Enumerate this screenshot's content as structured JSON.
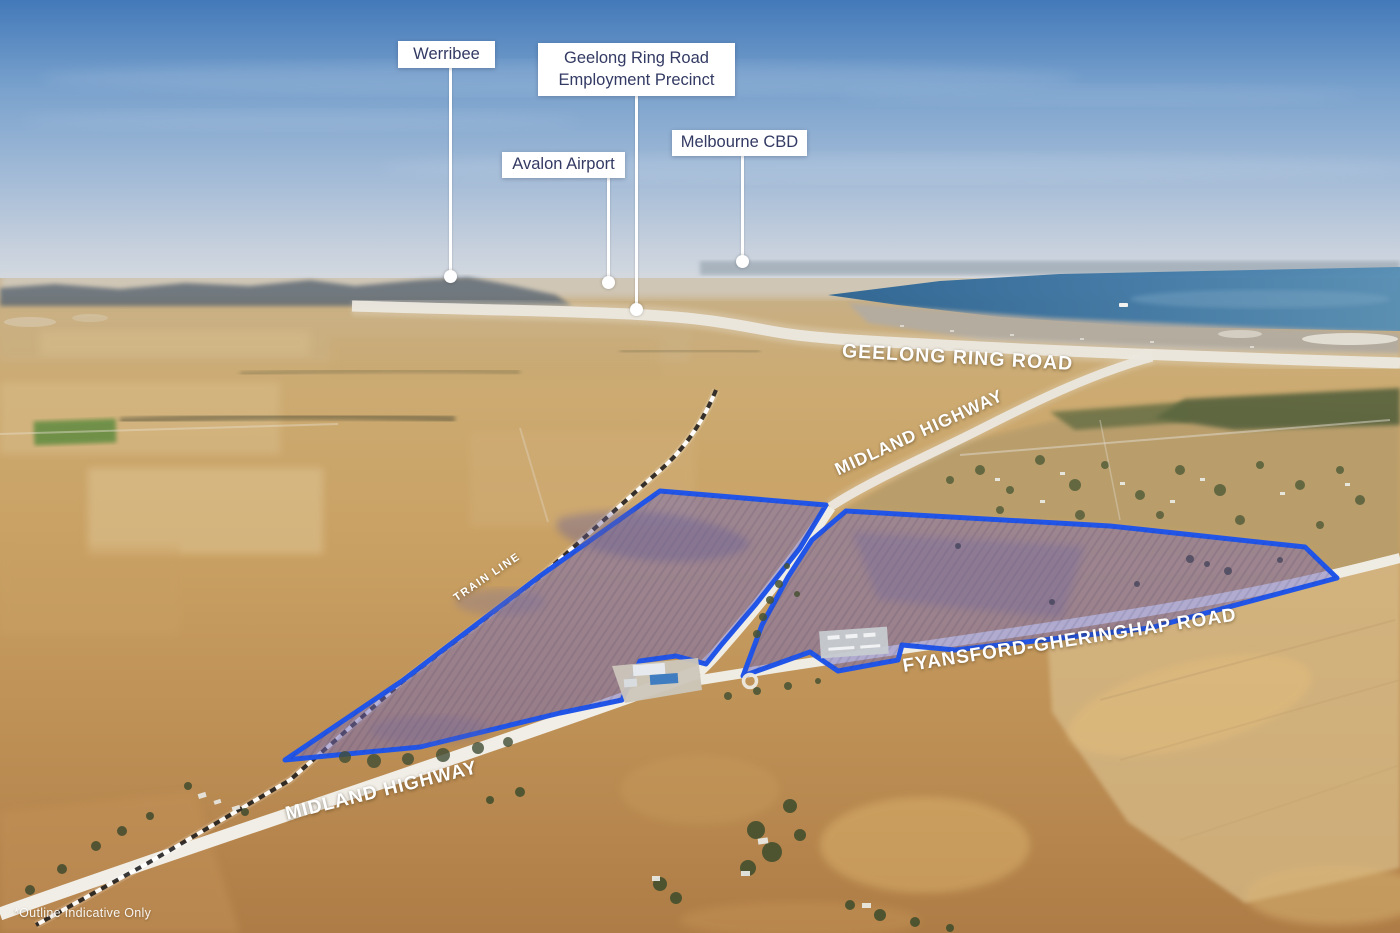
{
  "callouts": [
    {
      "label": "Werribee"
    },
    {
      "line1": "Geelong Ring Road",
      "line2": "Employment Precinct"
    },
    {
      "label": "Avalon Airport"
    },
    {
      "label": "Melbourne CBD"
    }
  ],
  "road_labels": [
    {
      "text": "GEELONG RING ROAD"
    },
    {
      "text": "MIDLAND HIGHWAY"
    },
    {
      "text": "TRAIN LINE"
    },
    {
      "text": "FYANSFORD-GHERINGHAP ROAD"
    },
    {
      "text": "MIDLAND HIGHWAY"
    }
  ],
  "disclaimer": "*Outline Indicative Only",
  "parcels": {
    "outline_color": "#2155E8",
    "fill_color": "rgba(114,106,186,0.5)",
    "west_points": "660,491 826,505 800,548 756,604 722,644 706,664 676,656 640,661 622,700 560,713 420,747 285,760 402,681 540,576",
    "east_points": "846,511 1110,526 1305,547 1337,578 1150,628 955,650 902,645 898,660 838,671 810,652 743,676 762,625 788,577 812,540"
  },
  "colors": {
    "callout_text": "#333A63",
    "callout_background": "#FFFFFF",
    "leader_line": "#FFFFFF",
    "road_label_text": "#FFFFFF"
  }
}
